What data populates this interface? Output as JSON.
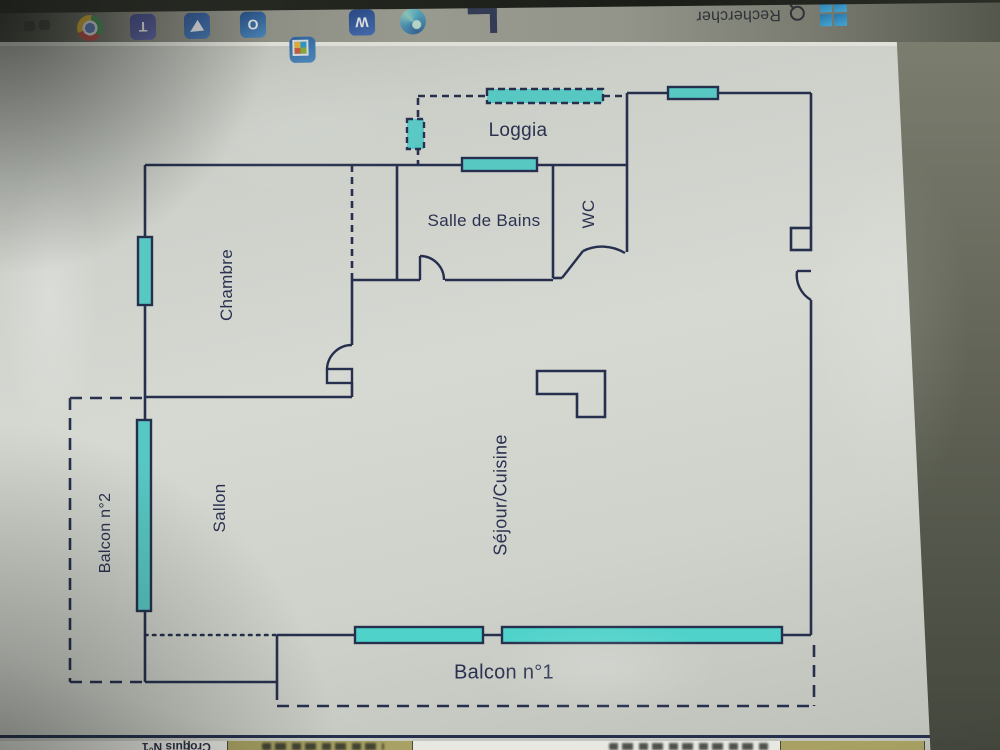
{
  "taskbar": {
    "search": {
      "label": "Rechercher"
    },
    "icons": [
      "tray-items",
      "chrome",
      "teams",
      "designer",
      "outlook",
      "microsoft-store",
      "word",
      "edge",
      "app-bracket",
      "search",
      "windows-start"
    ],
    "note_orientation": "taskbar appears rotated 180° in the photo"
  },
  "floor_plan": {
    "labels": {
      "loggia": "Loggia",
      "salle_de_bains": "Salle de Bains",
      "wc": "WC",
      "chambre": "Chambre",
      "sallon": "Sallon",
      "balcon2": "Balcon n°2",
      "sejour_cuisine": "Séjour/Cuisine",
      "balcon1": "Balcon n°1"
    }
  },
  "title_block": {
    "sketch_label": "Croquis N°1"
  },
  "colors": {
    "window_teal": "#58c8c3",
    "ink": "#26304e",
    "paper": "#d0d3cd",
    "taskbar_gray": "#93958b",
    "title_olive": "#a8a163"
  }
}
